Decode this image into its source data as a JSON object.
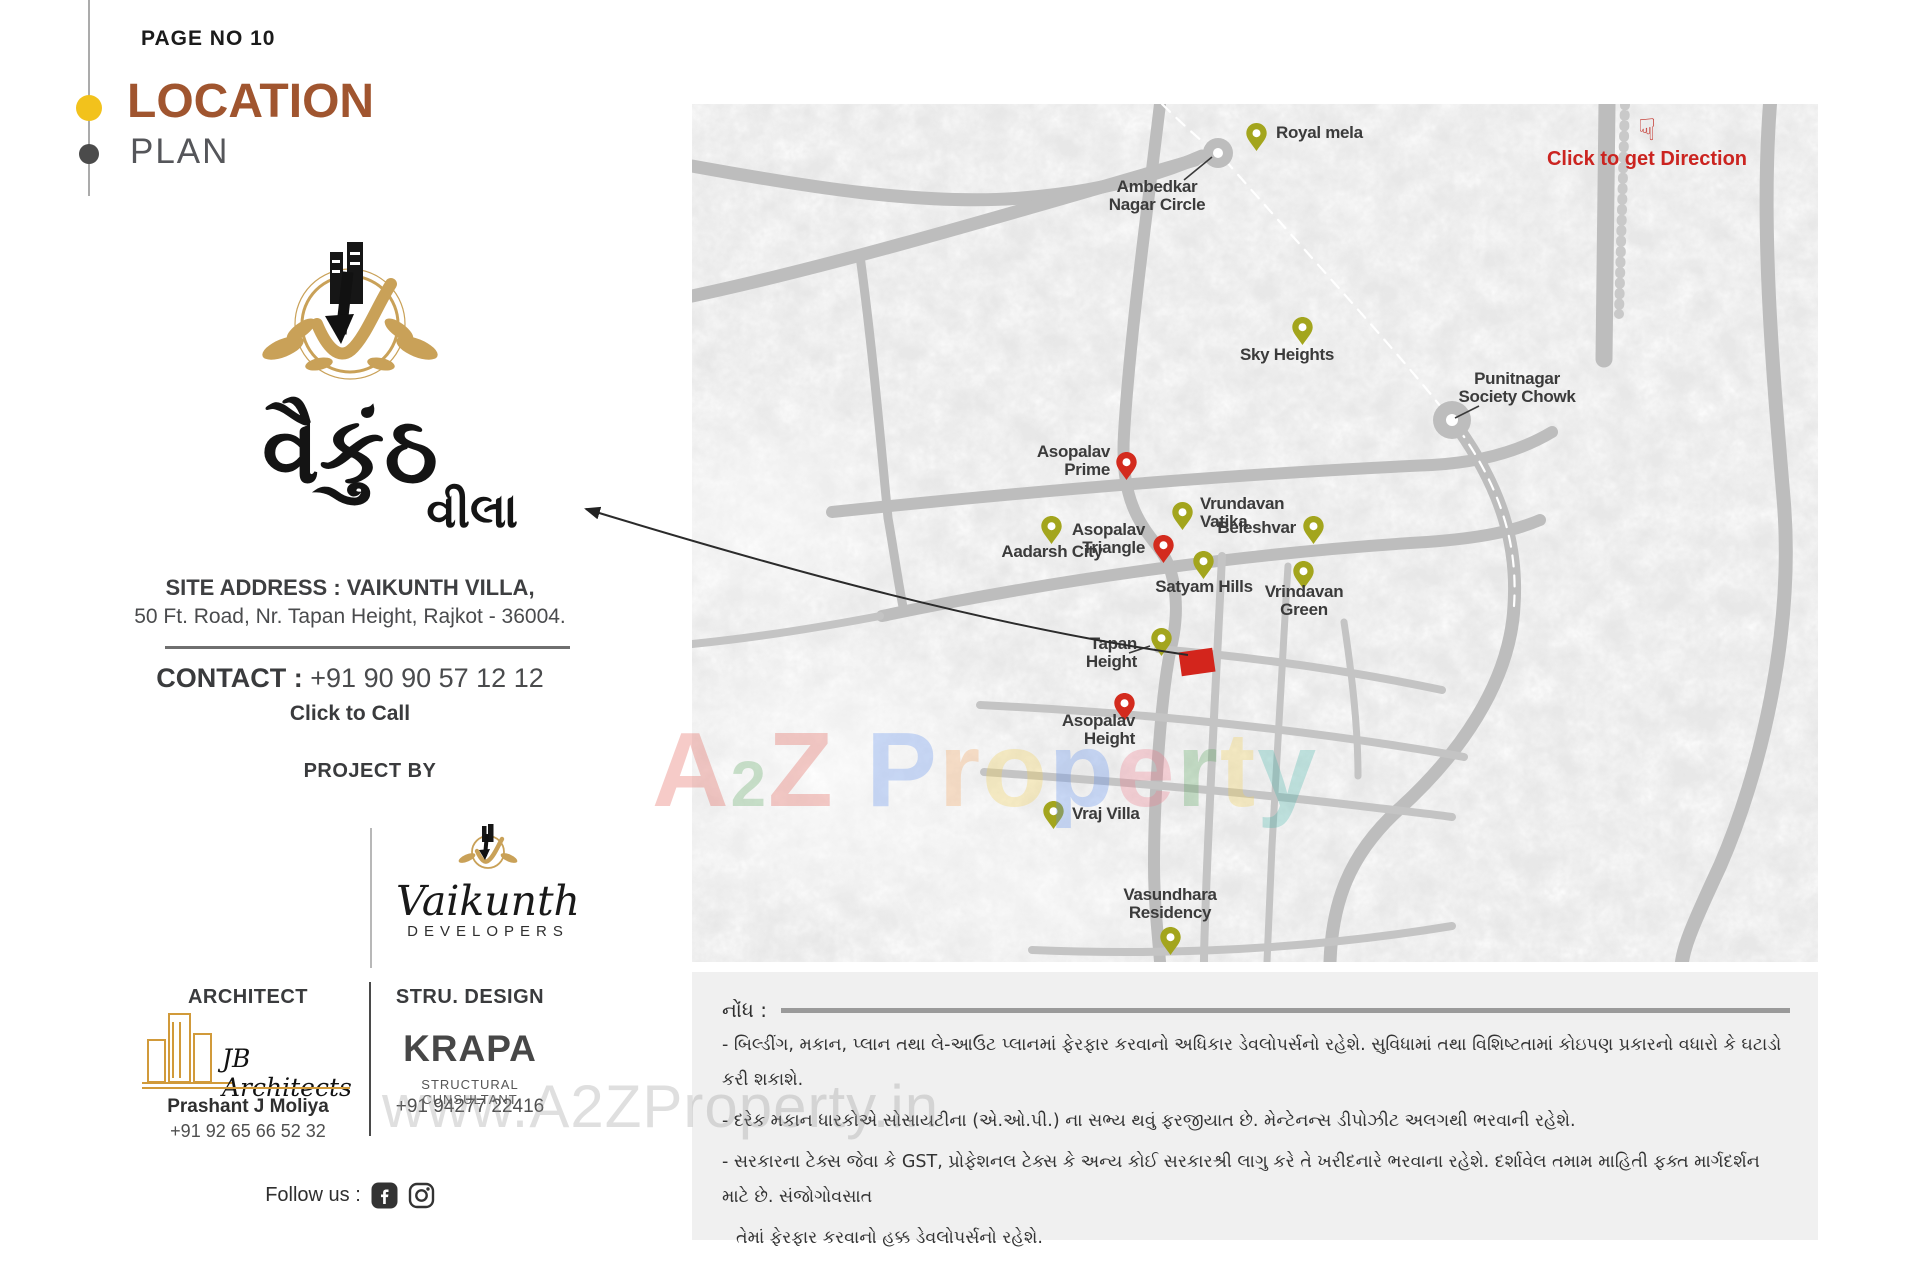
{
  "page": {
    "page_no": "PAGE NO 10",
    "title": "LOCATION",
    "subtitle": "PLAN"
  },
  "brand": {
    "logo_main": "વૈકુંઠ",
    "logo_sub": "વીલા"
  },
  "site": {
    "address_line1": "SITE ADDRESS : VAIKUNTH VILLA,",
    "address_line2": "50 Ft. Road, Nr. Tapan Height, Rajkot - 36004."
  },
  "contact": {
    "label": "CONTACT :",
    "phone": "+91 90 90 57 12 12",
    "click_to_call": "Click to Call"
  },
  "project": {
    "heading": "PROJECT BY",
    "developer_name": "Vaikunth",
    "developer_sub": "DEVELOPERS"
  },
  "architect": {
    "heading": "ARCHITECT",
    "firm": "JB Architects",
    "person": "Prashant J Moliya",
    "phone": "+91 92 65 66 52 32"
  },
  "structural": {
    "heading": "STRU. DESIGN",
    "firm": "KRAPA",
    "sub": "STRUCTURAL CUNSULTANT",
    "phone": "+91 94277 22416"
  },
  "social": {
    "label": "Follow us :",
    "icons": [
      "facebook",
      "instagram"
    ]
  },
  "map": {
    "direction_cta": "Click to get Direction",
    "direction_icon": "☟",
    "colors": {
      "pin_olive": "#A3A51D",
      "pin_red": "#D32B1E",
      "road": "#bdbdbd",
      "cta_red": "#CB2420"
    },
    "markers": [
      {
        "id": "royal-mela",
        "pin": {
          "x": 564,
          "y": 29,
          "c": "olive"
        },
        "label": {
          "x": 584,
          "y": 29,
          "anchor": "l",
          "lines": [
            "Royal mela"
          ]
        }
      },
      {
        "id": "ambedkar-nagar-circle",
        "label": {
          "x": 465,
          "y": 92,
          "anchor": "c",
          "lines": [
            "Ambedkar",
            "Nagar Circle"
          ]
        },
        "pointer": [
          492,
          76,
          520,
          53
        ]
      },
      {
        "id": "sky-heights",
        "pin": {
          "x": 610,
          "y": 223,
          "c": "olive"
        },
        "label": {
          "x": 595,
          "y": 251,
          "anchor": "c",
          "lines": [
            "Sky Heights"
          ]
        }
      },
      {
        "id": "punitnagar-society-chowk",
        "label": {
          "x": 825,
          "y": 284,
          "anchor": "c",
          "lines": [
            "Punitnagar",
            "Society Chowk"
          ]
        },
        "pointer": [
          787,
          302,
          763,
          314
        ]
      },
      {
        "id": "asopalav-prime",
        "pin": {
          "x": 434,
          "y": 358,
          "c": "red"
        },
        "label": {
          "x": 418,
          "y": 357,
          "anchor": "r",
          "lines": [
            "Asopalav",
            "Prime"
          ]
        }
      },
      {
        "id": "vrundavan-vatika",
        "pin": {
          "x": 490,
          "y": 408,
          "c": "olive"
        },
        "label": {
          "x": 508,
          "y": 409,
          "anchor": "l",
          "lines": [
            "Vrundavan",
            "Vatika"
          ]
        }
      },
      {
        "id": "beleshvar",
        "pin": {
          "x": 621,
          "y": 422,
          "c": "olive"
        },
        "label": {
          "x": 604,
          "y": 424,
          "anchor": "r",
          "lines": [
            "Beleshvar"
          ]
        }
      },
      {
        "id": "aadarsh-city",
        "pin": {
          "x": 359,
          "y": 422,
          "c": "olive"
        },
        "label": {
          "x": 360,
          "y": 448,
          "anchor": "c",
          "lines": [
            "Aadarsh City"
          ]
        }
      },
      {
        "id": "asopalav-triangle",
        "pin": {
          "x": 471,
          "y": 441,
          "c": "red"
        },
        "label": {
          "x": 453,
          "y": 435,
          "anchor": "r",
          "lines": [
            "Asopalav",
            "Triangle"
          ]
        }
      },
      {
        "id": "satyam-hills",
        "pin": {
          "x": 511,
          "y": 457,
          "c": "olive"
        },
        "label": {
          "x": 512,
          "y": 483,
          "anchor": "c",
          "lines": [
            "Satyam Hills"
          ]
        }
      },
      {
        "id": "vrindavan-green",
        "pin": {
          "x": 611,
          "y": 467,
          "c": "olive"
        },
        "label": {
          "x": 612,
          "y": 497,
          "anchor": "c",
          "lines": [
            "Vrindavan",
            "Green"
          ]
        }
      },
      {
        "id": "tapan-height",
        "pin": {
          "x": 469,
          "y": 534,
          "c": "olive"
        },
        "label": {
          "x": 445,
          "y": 549,
          "anchor": "r",
          "lines": [
            "Tapan",
            "Height"
          ]
        },
        "pointer": [
          437,
          549,
          458,
          542
        ]
      },
      {
        "id": "asopalav-height",
        "pin": {
          "x": 432,
          "y": 599,
          "c": "red"
        },
        "label": {
          "x": 443,
          "y": 626,
          "anchor": "r",
          "lines": [
            "Asopalav",
            "Height"
          ]
        }
      },
      {
        "id": "vraj-villa",
        "pin": {
          "x": 361,
          "y": 707,
          "c": "olive"
        },
        "label": {
          "x": 380,
          "y": 710,
          "anchor": "l",
          "lines": [
            "Vraj Villa"
          ]
        }
      },
      {
        "id": "vasundhara-residency",
        "pin": {
          "x": 478,
          "y": 833,
          "c": "olive"
        },
        "label": {
          "x": 478,
          "y": 800,
          "anchor": "c",
          "lines": [
            "Vasundhara",
            "Residency"
          ]
        }
      }
    ]
  },
  "watermarks": {
    "www_text": "www.A2ZProperty.in",
    "center_letters": [
      {
        "t": "A",
        "c": "#e2574c"
      },
      {
        "t": "2",
        "c": "#58a55c",
        "sub": true
      },
      {
        "t": "Z",
        "c": "#e2574c"
      },
      {
        "t": " ",
        "c": ""
      },
      {
        "t": "P",
        "c": "#5b8def"
      },
      {
        "t": "r",
        "c": "#f4a259"
      },
      {
        "t": "o",
        "c": "#f3cf4f"
      },
      {
        "t": "p",
        "c": "#5b8def"
      },
      {
        "t": "e",
        "c": "#ef798a"
      },
      {
        "t": "r",
        "c": "#58a55c"
      },
      {
        "t": "t",
        "c": "#f3cf4f"
      },
      {
        "t": "y",
        "c": "#45b5aa"
      }
    ]
  },
  "notes": {
    "heading": "નોંધ :",
    "lines": [
      "- બિલ્ડીંગ, મકાન, પ્લાન તથા લે-આઉટ પ્લાનમાં ફેરફાર કરવાનો અધિકાર ડેવલોપર્સનો રહેશે.  સુવિધામાં તથા વિશિષ્ટતામાં કોઇપણ પ્રકારનો વધારો કે ઘટાડો કરી શકાશે.",
      "- દરેક મકાન ધારકોએ સોસાયટીના (એ.ઓ.પી.) ના સભ્ય થવું ફરજીયાત છે. મેન્ટેનન્સ ડીપોઝીટ અલગથી ભરવાની રહેશે.",
      "- સરકારના ટેક્સ જેવા કે GST, પ્રોફેશનલ ટેક્સ કે અન્ય કોઈ સરકારશ્રી લાગુ કરે તે ખરીદનારે ભરવાના રહેશે. દર્શાવેલ તમામ માહિતી ફક્ત માર્ગદર્શન માટે છે. સંજોગોવસાત",
      "તેમાં ફેરફાર કરવાનો હક્ક ડેવલોપર્સનો રહેશે."
    ]
  }
}
